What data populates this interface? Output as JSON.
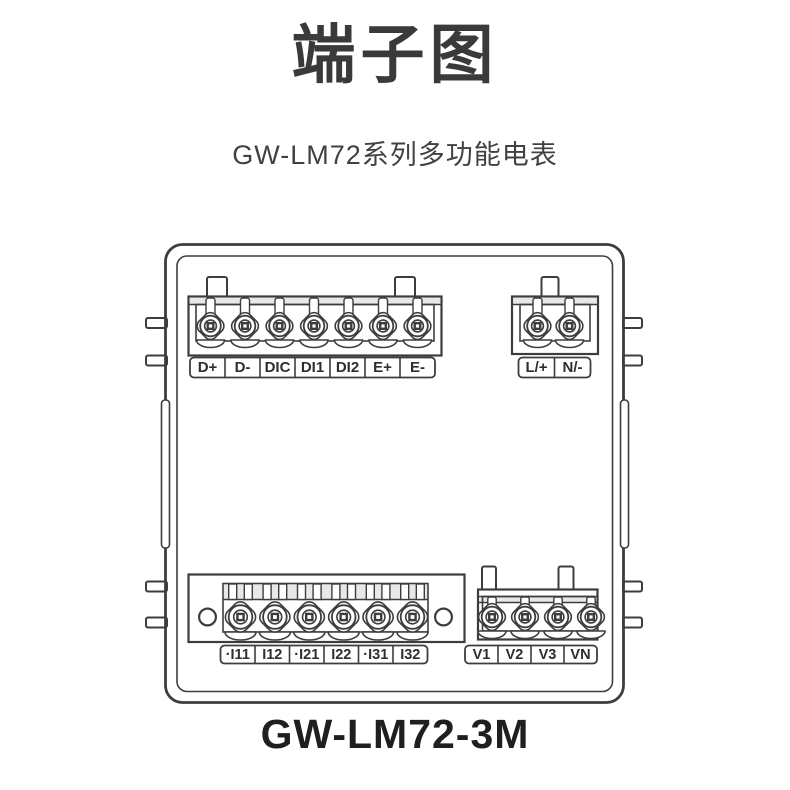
{
  "page": {
    "title": "端子图",
    "subtitle": "GW-LM72系列多功能电表",
    "model": "GW-LM72-3M"
  },
  "colors": {
    "background": "#ffffff",
    "line": "#3d3d3d",
    "title_text": "#3a3a3a",
    "subtitle_text": "#414141",
    "model_text": "#1f1f1f",
    "strip_fill": "#e8e8e8"
  },
  "terminal_blocks": {
    "comm_io": {
      "labels": [
        "D+",
        "D-",
        "DIC",
        "DI1",
        "DI2",
        "E+",
        "E-"
      ]
    },
    "aux_power": {
      "labels": [
        "L/+",
        "N/-"
      ]
    },
    "current_inputs": {
      "labels": [
        "·I11",
        "I12",
        "·I21",
        "I22",
        "·I31",
        "I32"
      ]
    },
    "voltage_inputs": {
      "labels": [
        "V1",
        "V2",
        "V3",
        "VN"
      ]
    }
  }
}
